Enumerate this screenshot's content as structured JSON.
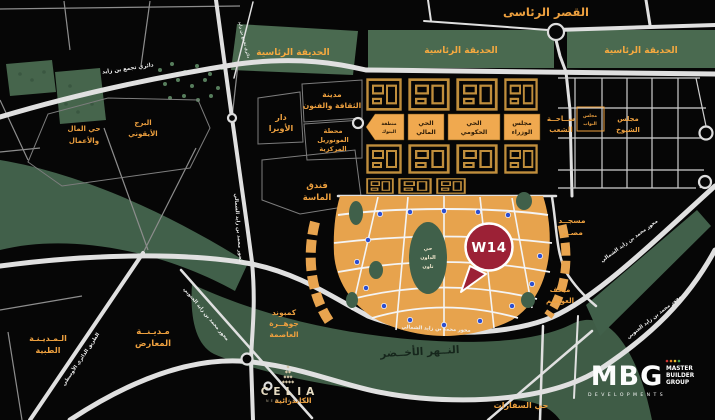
{
  "map": {
    "landmarks": {
      "presidential_palace": "القصر الرئاسى",
      "presidential_park": "الحديقة الرئاسية",
      "opera_house": [
        "دار",
        "الأوبرا"
      ],
      "culture_arts_city": [
        "مدينة",
        "الثقافة والفنون"
      ],
      "central_monorail_station": [
        "محطة",
        "المونوريل",
        "المركزية"
      ],
      "almasa_hotel": [
        "فندق",
        "الماسة"
      ],
      "egypt_mosque": [
        "مسجــد",
        "مصــر"
      ],
      "capitals_museum": [
        "متحف",
        "العواصم"
      ],
      "green_river": "النــهر الأخــضر",
      "iconic_tower": [
        "البرج",
        "الأيقوني"
      ],
      "money_business_district": [
        "حي المال",
        "والأعمال"
      ],
      "medical_city": [
        "الـمـديـنـة",
        "الطبية"
      ],
      "expo_city": [
        "مـديـنــة",
        "المعارض"
      ],
      "jewel_compound": [
        "كمبوند",
        "جوهــرة",
        "العاصمة"
      ],
      "cathedral": "الكاتدرائية",
      "embassies_district": "حي السفارات",
      "downtown": [
        "حي",
        "الداون",
        "تاون"
      ]
    },
    "government_district": {
      "banks_zone": [
        "منطقة",
        "البنوك"
      ],
      "financial_district": [
        "الحي",
        "المالي"
      ],
      "governmental_district": [
        "الحي",
        "الحكومي"
      ],
      "cabinet": [
        "مجلس",
        "الوزراء"
      ],
      "peoples_square": [
        "ســاحــة",
        "الشعب"
      ],
      "parliament": [
        "مجلس",
        "النواب"
      ],
      "senate": [
        "مجلس",
        "الشيوخ"
      ]
    },
    "roads": {
      "bin_zayed_ring": "دائري تجمع بن زايد",
      "mbz_north": "محور محمد بن زايد الشمالي",
      "mbz_south": "محور محمد بن زايد الجنوبي",
      "middle_ring": "الطريق الدائري الأوسطي"
    },
    "marker": {
      "label": "W14"
    },
    "logos": {
      "celia": {
        "name": "CELIA",
        "sub": "NEW CAPITAL"
      },
      "mbg": {
        "name": "MBG",
        "sub": "DEVELOPMENTS",
        "group": [
          "MASTER",
          "BUILDER",
          "GROUP"
        ]
      }
    },
    "colors": {
      "park_green": "#4a6a50",
      "river_green": "#3f5c46",
      "block_orange": "#f0a94f",
      "label_orange": "#eda03f",
      "road_white": "#e0e0e0",
      "pin_red": "#9c2136",
      "station_blue": "#2e4fd0"
    }
  }
}
